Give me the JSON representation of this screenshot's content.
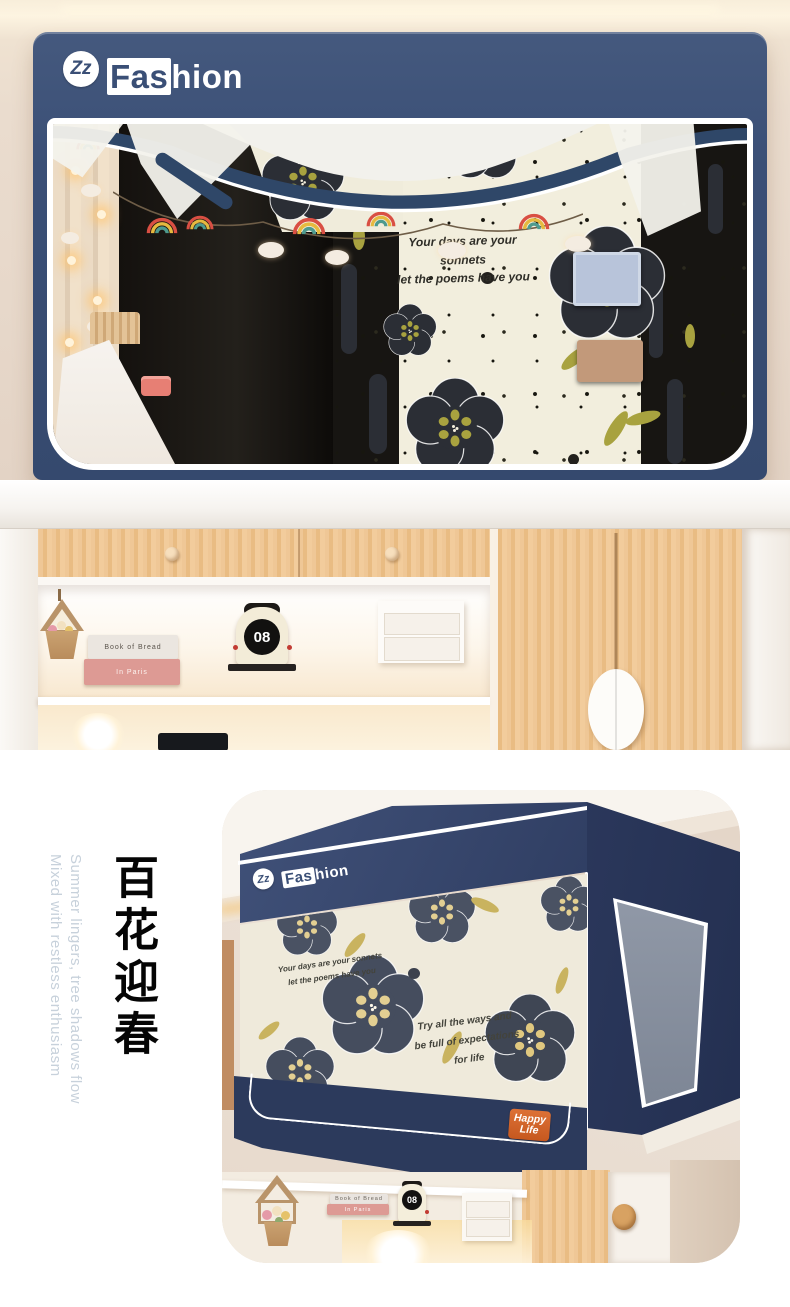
{
  "brand": {
    "monogram": "Zz",
    "name_highlight": "Fas",
    "name_rest": "hion"
  },
  "fabric": {
    "quote1_line1": "Your days are your sonnets",
    "quote1_line2": "let the poems have you",
    "quote2_line1": "Try all the ways and",
    "quote2_line2": "be full of expectations",
    "quote2_line3": "for life"
  },
  "desk": {
    "clock_number": "08",
    "book_top": "Book of Bread",
    "book_bottom": "In Paris"
  },
  "bottom": {
    "headline_cn": "百花迎春",
    "tagline_en_1": "Summer lingers, tree shadows flow",
    "tagline_en_2": "Mixed with restless enthusiasm",
    "badge_line1": "Happy",
    "badge_line2": "Life"
  },
  "colors": {
    "navy": "#3a4f76",
    "navy_deep": "#2d3b5f",
    "cream_fabric": "#f2eedd",
    "flower_black": "#2b2e35",
    "flower_slate": "#4a5263",
    "olive": "#a8a23f",
    "olive_soft": "#cdb966",
    "badge_orange": "#d2622e",
    "wood": "#eec495",
    "wall": "#e9ddd2",
    "tagline_gray": "#c7d1db"
  }
}
